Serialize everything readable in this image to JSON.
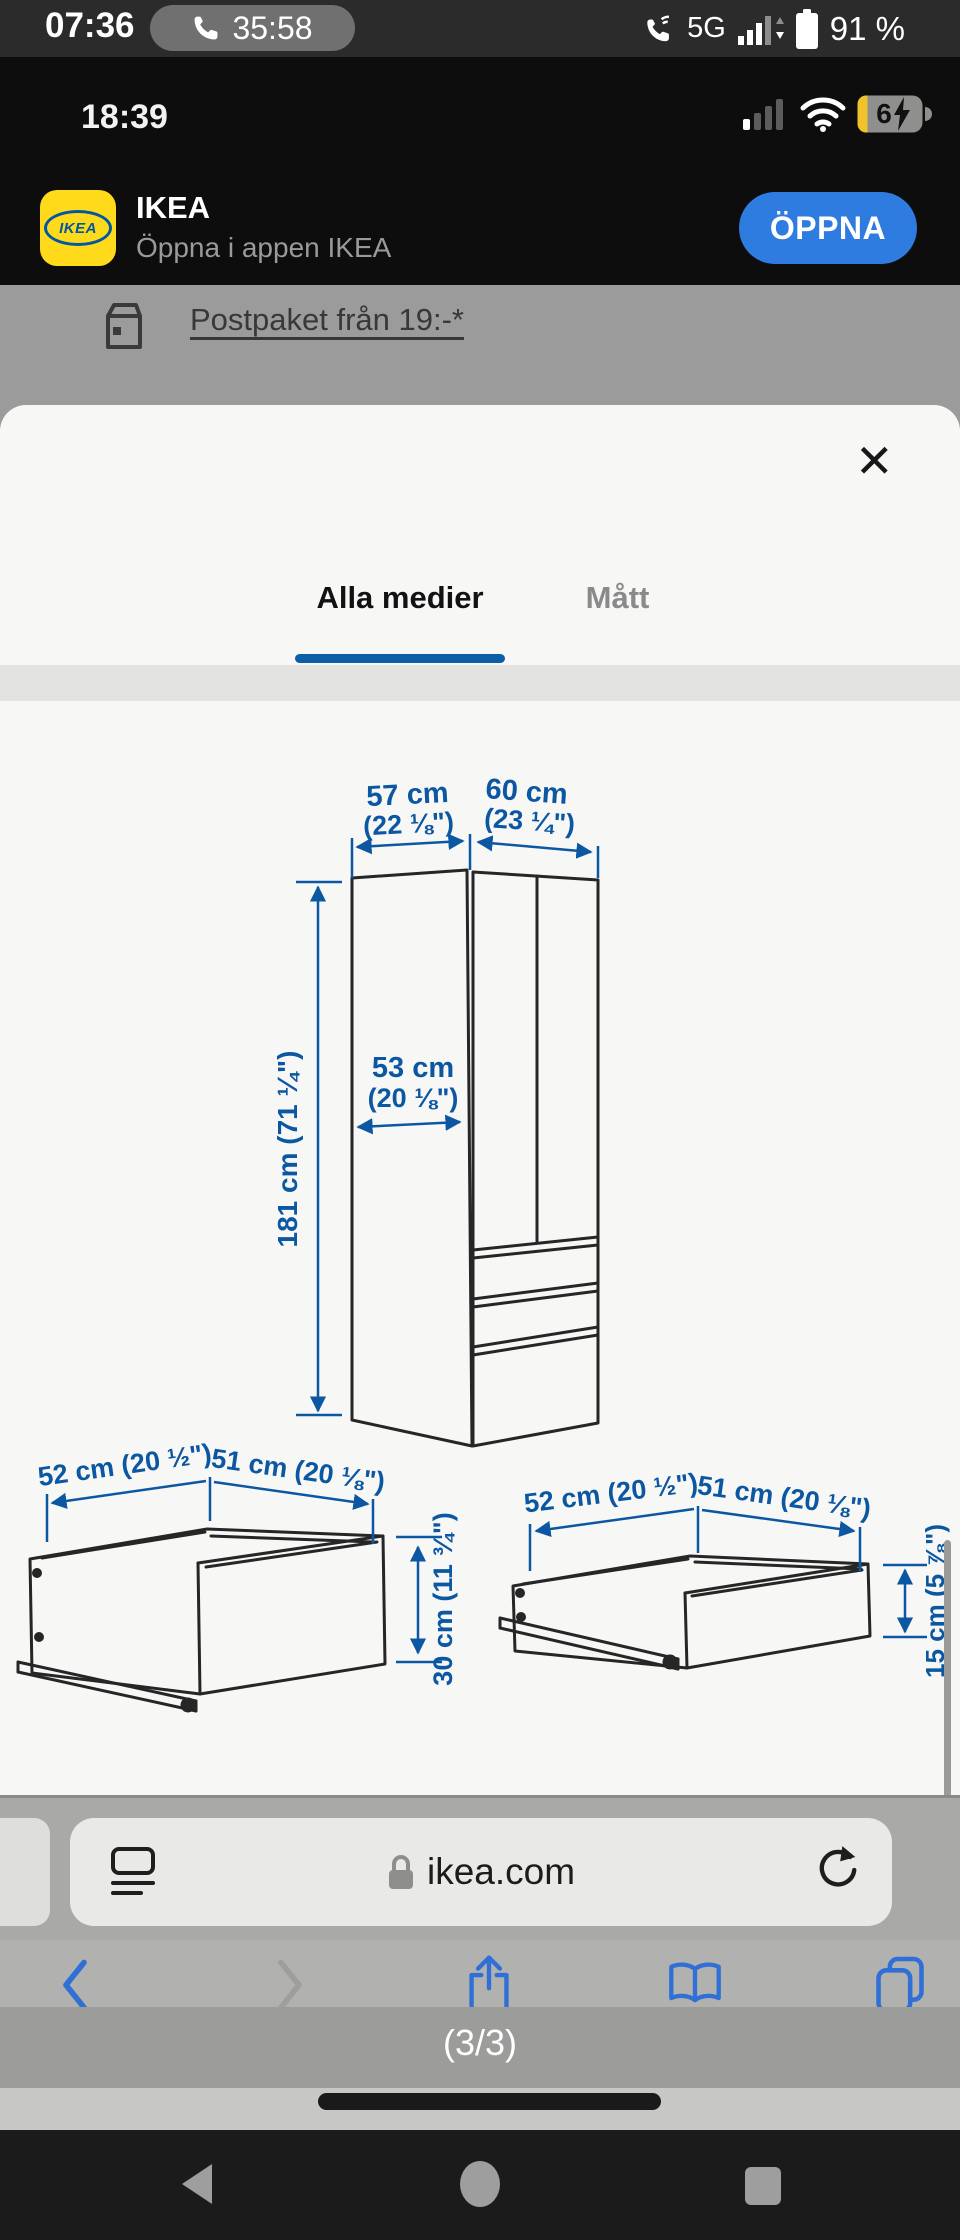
{
  "android_status": {
    "time": "07:36",
    "call_timer": "35:58",
    "network": "5G",
    "battery": "91 %"
  },
  "ios_status": {
    "time": "18:39",
    "battery_level": "6"
  },
  "app_banner": {
    "logo_text": "IKEA",
    "title": "IKEA",
    "subtitle": "Öppna i appen IKEA",
    "action_label": "ÖPPNA"
  },
  "page_behind": {
    "link_text": "Postpaket från 19:-*"
  },
  "sheet": {
    "close_glyph": "✕",
    "tabs": [
      {
        "label": "Alla medier",
        "active": true
      },
      {
        "label": "Mått",
        "active": false
      }
    ]
  },
  "diagram": {
    "cabinet": {
      "width_left": "57 cm",
      "width_left_in": "(22 ⅛\")",
      "width_right": "60 cm",
      "width_right_in": "(23 ¼\")",
      "inner_width": "53 cm",
      "inner_width_in": "(20 ⅛\")",
      "height": "181 cm (71 ¼\")"
    },
    "drawer_large": {
      "width": "52 cm (20 ½\")",
      "depth": "51 cm (20 ⅛\")",
      "height": "30 cm (11 ¾\")"
    },
    "drawer_small": {
      "width": "52 cm (20 ½\")",
      "depth": "51 cm (20 ⅛\")",
      "height": "15 cm (5 ⅞\")"
    }
  },
  "browser": {
    "url": "ikea.com",
    "page_count": "(3/3)"
  }
}
